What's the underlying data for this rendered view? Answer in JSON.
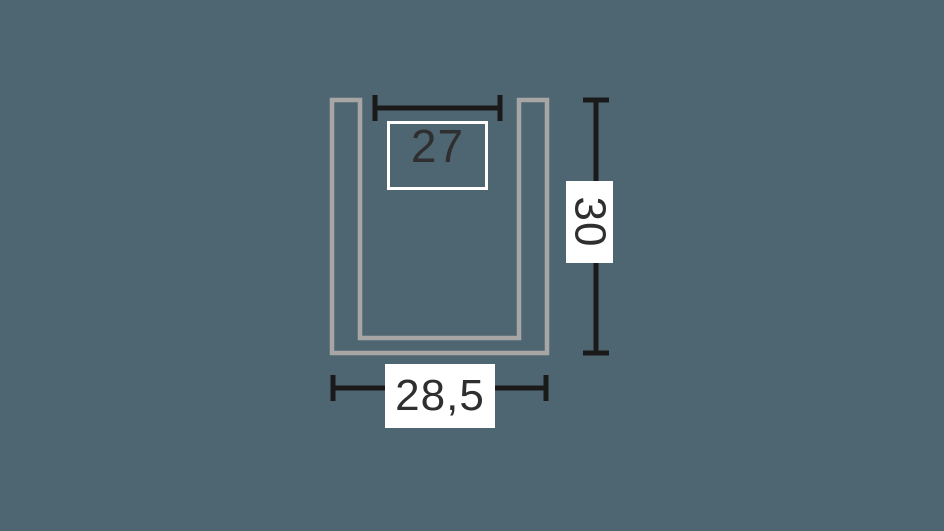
{
  "colors": {
    "background": "#4d6671",
    "profile_stroke": "#a7a6a4",
    "dimension_line": "#1a1a1a",
    "label_text": "#2f2f2f",
    "label_background": "#ffffff",
    "label_border": "#ffffff"
  },
  "diagram": {
    "kind": "u-channel-profile-cross-section",
    "dimensions": {
      "inner_width": {
        "value": "27"
      },
      "height": {
        "value": "30"
      },
      "outer_width": {
        "value": "28,5"
      }
    }
  }
}
